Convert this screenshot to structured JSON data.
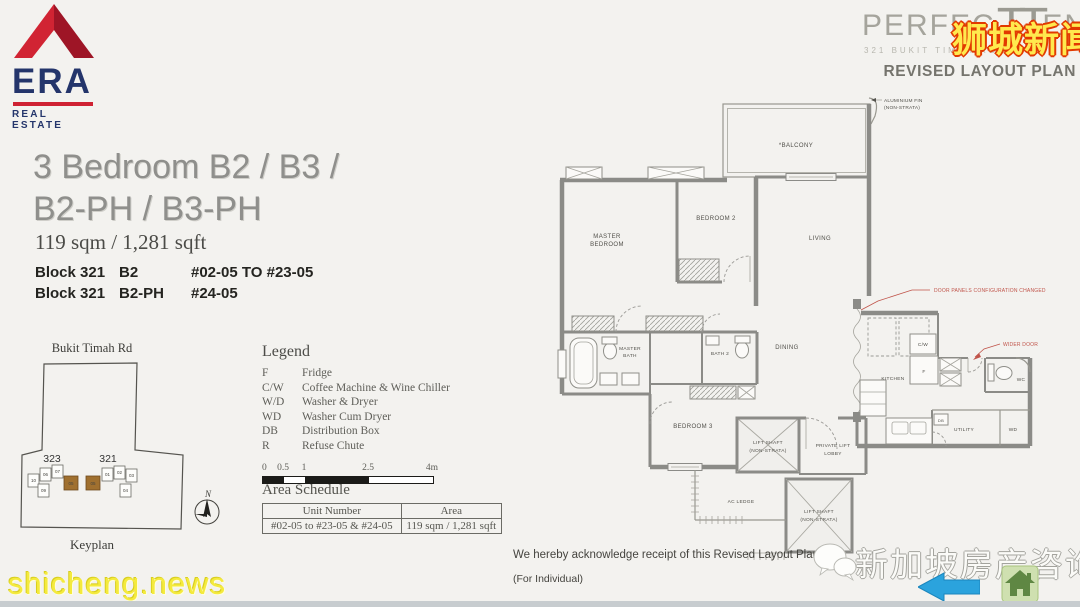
{
  "era_logo": {
    "name": "ERA",
    "tagline": "REAL ESTATE"
  },
  "project": {
    "name_part1": "PERFEC",
    "monogram": "TT",
    "name_part2": "EN",
    "address": "321 BUKIT TIMAH ROAD",
    "plan_type": "REVISED LAYOUT PLAN"
  },
  "watermarks": {
    "top_right": "狮城新闻",
    "bottom_left": "shicheng.news",
    "bottom_right": "新加坡房产咨询"
  },
  "title": {
    "line1": "3 Bedroom B2 / B3 /",
    "line2": "B2-PH / B3-PH",
    "area": "119 sqm / 1,281 sqft"
  },
  "blocks": [
    {
      "block": "Block 321",
      "type": "B2",
      "units": "#02-05 TO #23-05"
    },
    {
      "block": "Block 321",
      "type": "B2-PH",
      "units": "#24-05"
    }
  ],
  "keyplan": {
    "road": "Bukit Timah Rd",
    "label": "Keyplan",
    "compass": "N",
    "building_left": "323",
    "building_right": "321",
    "units_left": [
      "10",
      "06",
      "07",
      "09",
      "05"
    ],
    "units_right": [
      "05",
      "01",
      "02",
      "03",
      "04"
    ]
  },
  "legend": {
    "title": "Legend",
    "items": [
      {
        "abbr": "F",
        "desc": "Fridge"
      },
      {
        "abbr": "C/W",
        "desc": "Coffee Machine & Wine Chiller"
      },
      {
        "abbr": "W/D",
        "desc": "Washer & Dryer"
      },
      {
        "abbr": "WD",
        "desc": "Washer Cum Dryer"
      },
      {
        "abbr": "DB",
        "desc": "Distribution Box"
      },
      {
        "abbr": "R",
        "desc": "Refuse Chute"
      }
    ],
    "scale_ticks": [
      "0",
      "0.5",
      "1",
      "2.5",
      "4m"
    ]
  },
  "area_schedule": {
    "title": "Area Schedule",
    "headers": [
      "Unit Number",
      "Area"
    ],
    "rows": [
      [
        "#02-05 to #23-05 & #24-05",
        "119 sqm / 1,281 sqft"
      ]
    ]
  },
  "floor_plan": {
    "labels": {
      "balcony": "*BALCONY",
      "master_bedroom_1": "MASTER",
      "master_bedroom_2": "BEDROOM",
      "bedroom2": "BEDROOM 2",
      "living": "LIVING",
      "master_bath_1": "MASTER",
      "master_bath_2": "BATH",
      "bath2": "BATH 2",
      "dining": "DINING",
      "kitchen": "KITCHEN",
      "cw": "C/W",
      "f": "F",
      "wc": "WC",
      "utility": "UTILITY",
      "wd": "WD",
      "db": "DB",
      "bedroom3": "BEDROOM 3",
      "lift_shaft": "LIFT SHAFT",
      "non_strata": "(NON-STRATA)",
      "lobby_1": "PRIVATE LIFT",
      "lobby_2": "LOBBY",
      "ac_ledge": "AC LEDGE",
      "fin": "ALUMINIUM FIN"
    },
    "annotations": {
      "door_panels": "DOOR PANELS CONFIGURATION CHANGED",
      "wider_door": "WIDER DOOR"
    }
  },
  "acknowledgment": {
    "line1": "We hereby acknowledge receipt of this Revised Layout Plan.",
    "line2": "(For Individual)"
  },
  "colors": {
    "era_red": "#cf2233",
    "era_navy": "#24356b",
    "logo_gray": "#a5a49c",
    "annotation_red": "#c0544a",
    "watermark_yellow": "#ffe94e",
    "watermark_outline": "#e23a00",
    "arrow_blue": "#2ba3dd",
    "house_green": "#5f8743"
  }
}
